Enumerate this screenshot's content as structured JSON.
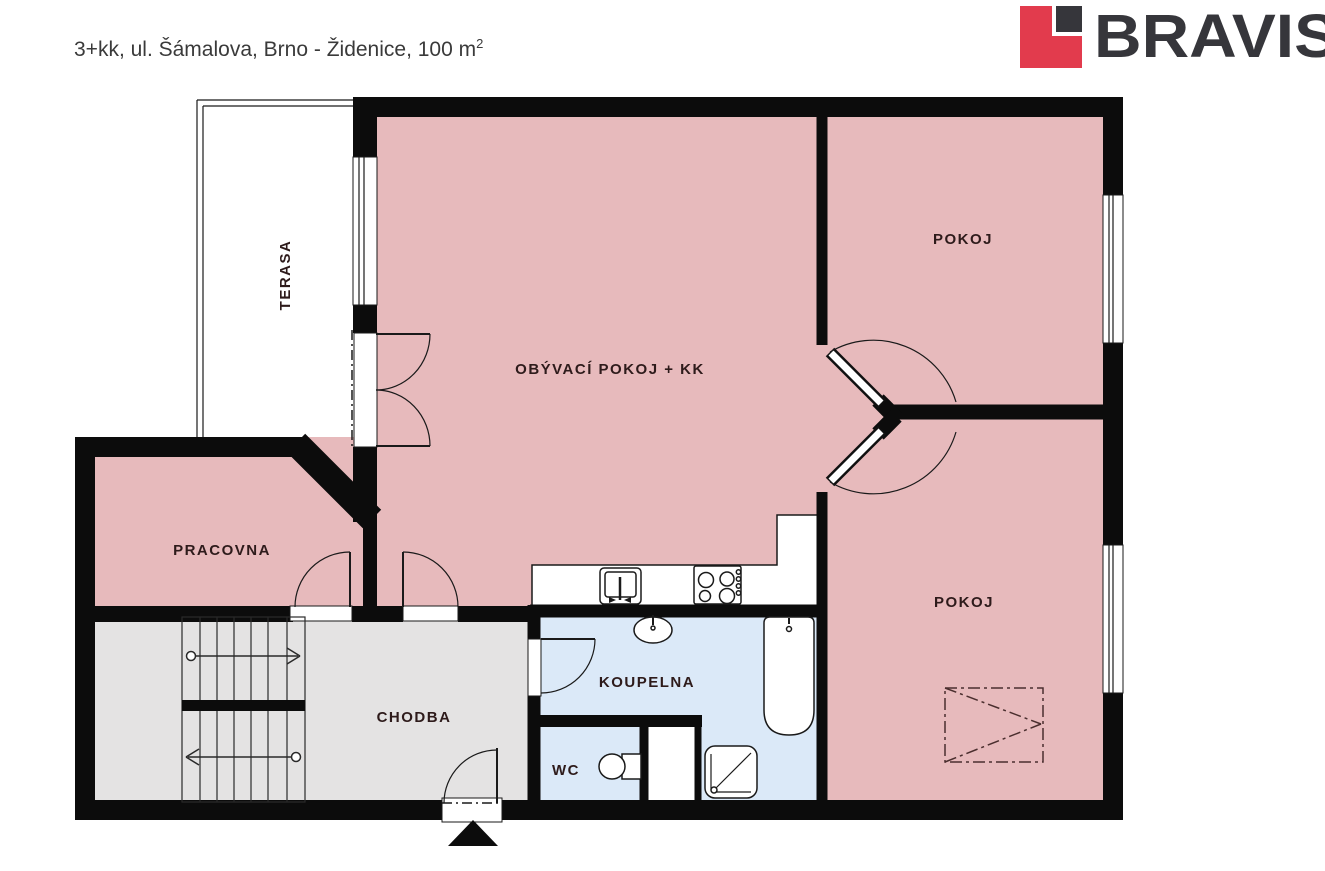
{
  "header": {
    "title": "3+kk, ul. Šámalova, Brno - Židenice, 100 m",
    "title_sup": "2"
  },
  "logo": {
    "text": "BRAVIS",
    "red": "#e23b4d",
    "dark": "#36363b"
  },
  "colors": {
    "room_pink": "#e7babc",
    "hall_gray": "#e4e3e3",
    "bath_blue": "#dbe9f8",
    "wall": "#0c0c0c",
    "door_arc": "#42292b",
    "label": "#2e1b1b"
  },
  "rooms": [
    {
      "id": "terasa",
      "label": "TERASA"
    },
    {
      "id": "obyvaci-pokoj-kk",
      "label": "OBÝVACÍ POKOJ + KK"
    },
    {
      "id": "pokoj-top",
      "label": "POKOJ"
    },
    {
      "id": "pokoj-bottom",
      "label": "POKOJ"
    },
    {
      "id": "pracovna",
      "label": "PRACOVNA"
    },
    {
      "id": "chodba",
      "label": "CHODBA"
    },
    {
      "id": "koupelna",
      "label": "KOUPELNA"
    },
    {
      "id": "wc",
      "label": "WC"
    }
  ],
  "fixtures": [
    "kitchen-sink",
    "cooktop",
    "washbasin",
    "bathtub",
    "shower",
    "toilet",
    "wardrobe-dashed",
    "staircase",
    "entrance-marker"
  ]
}
